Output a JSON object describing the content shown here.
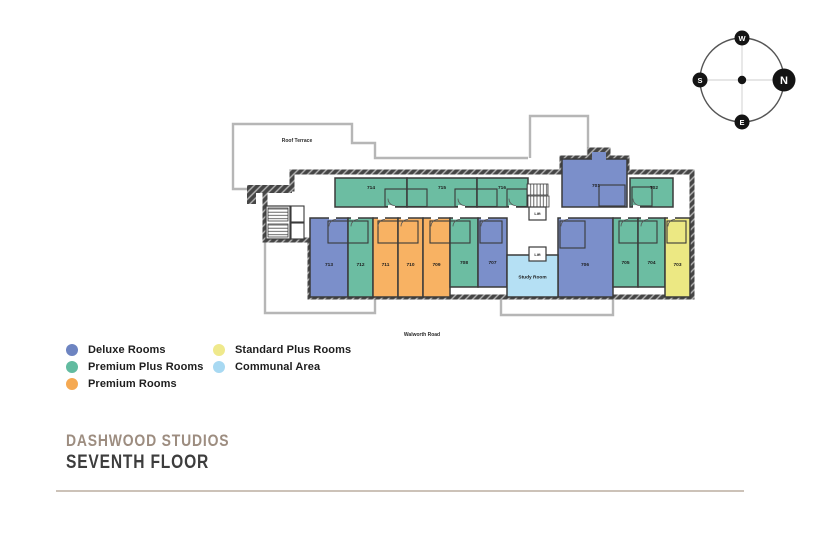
{
  "compass": {
    "north": "N",
    "south": "S",
    "east": "E",
    "west": "W"
  },
  "colors": {
    "deluxe": "#7b8fca",
    "premium_plus": "#6cbda2",
    "premium": "#f8b263",
    "standard_plus": "#ece883",
    "communal": "#b5e0f4",
    "wall": "#3a3a3a"
  },
  "plan": {
    "roof_terrace": "Roof Terrace",
    "road": "Walworth Road",
    "lift_upper": "Lift",
    "lift_lower": "Lift",
    "study_room": "Study Room"
  },
  "rooms": {
    "r701": "701",
    "r702": "702",
    "r703": "703",
    "r704": "704",
    "r705": "705",
    "r706": "706",
    "r707": "707",
    "r708": "708",
    "r709": "709",
    "r710": "710",
    "r711": "711",
    "r712": "712",
    "r713": "713",
    "r714": "714",
    "r715": "715",
    "r716": "716"
  },
  "legend": {
    "items": [
      {
        "label": "Deluxe Rooms",
        "color": "#6d84c1"
      },
      {
        "label": "Premium Plus Rooms",
        "color": "#62bba0"
      },
      {
        "label": "Premium Rooms",
        "color": "#f5a952"
      },
      {
        "label": "Standard Plus Rooms",
        "color": "#efe98c"
      },
      {
        "label": "Communal Area",
        "color": "#a8d9f2"
      }
    ]
  },
  "footer": {
    "brand": "DASHWOOD STUDIOS",
    "floor": "SEVENTH FLOOR"
  }
}
